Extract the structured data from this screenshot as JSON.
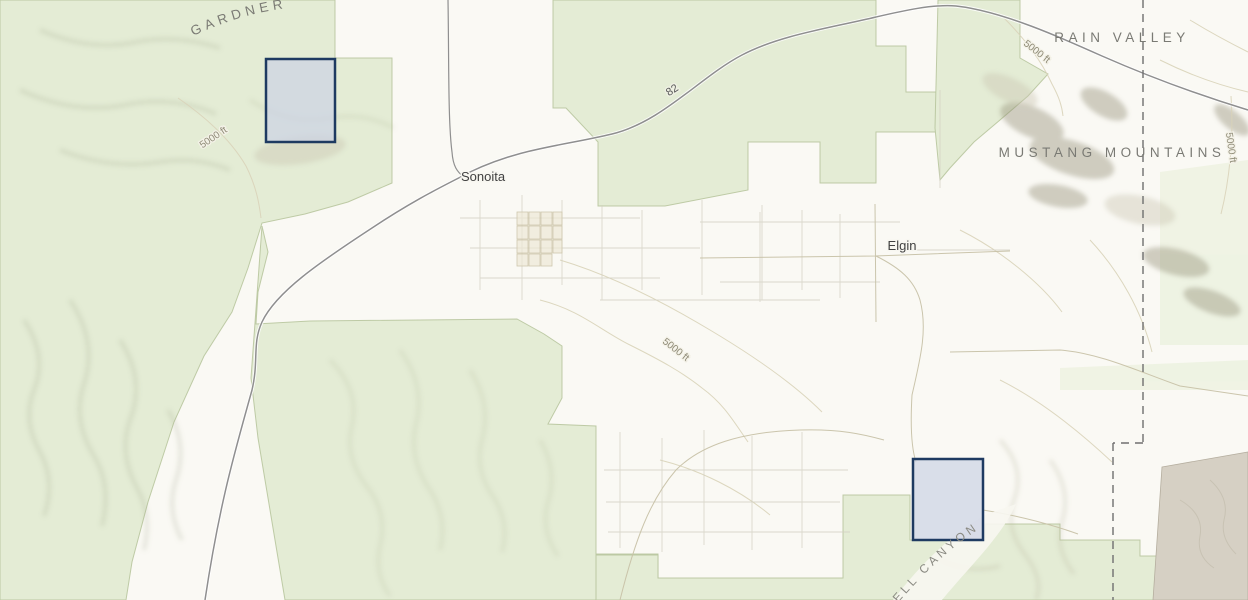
{
  "map": {
    "labels": {
      "gardner": "GARDNER",
      "rain_valley": "RAIN VALLEY",
      "mustang_mountains": "MUSTANG MOUNTAINS",
      "sonoita": "Sonoita",
      "elgin": "Elgin",
      "highway_82": "82",
      "canyon": "ELL CANYON",
      "contour_left": "5000 ft",
      "contour_mid": "5000 ft",
      "contour_ne": "5000 ft",
      "contour_right": "5000 ft"
    },
    "parcels": [
      {
        "x": 266,
        "y": 59,
        "width": 69,
        "height": 83,
        "fill": "#ccd2e4",
        "fill_opacity": "0.72",
        "stroke": "#1e3a61",
        "stroke_width": "2.5"
      },
      {
        "x": 913,
        "y": 459,
        "width": 70,
        "height": 81,
        "fill": "#ccd2e4",
        "fill_opacity": "0.72",
        "stroke": "#1e3a61",
        "stroke_width": "2.5"
      }
    ],
    "colors": {
      "land": "#faf9f4",
      "forest": "#e4ecd5",
      "forest_pale": "#edf2e1",
      "forest_border": "#b5c39a",
      "highway": "#8f8f8f",
      "highway_casing": "#ffffff",
      "minor_road": "#c8c2a8",
      "parcel_line": "#d3d0c2",
      "contour": "#d9d3b9",
      "boundary_dash": "#6f6f6f",
      "military_area": "#d6d0c4",
      "hillshade_dark": "#9aa083",
      "hillshade_brown": "#8f8a74",
      "terrain_label": "#7a7a74",
      "town_label": "#414141"
    }
  }
}
